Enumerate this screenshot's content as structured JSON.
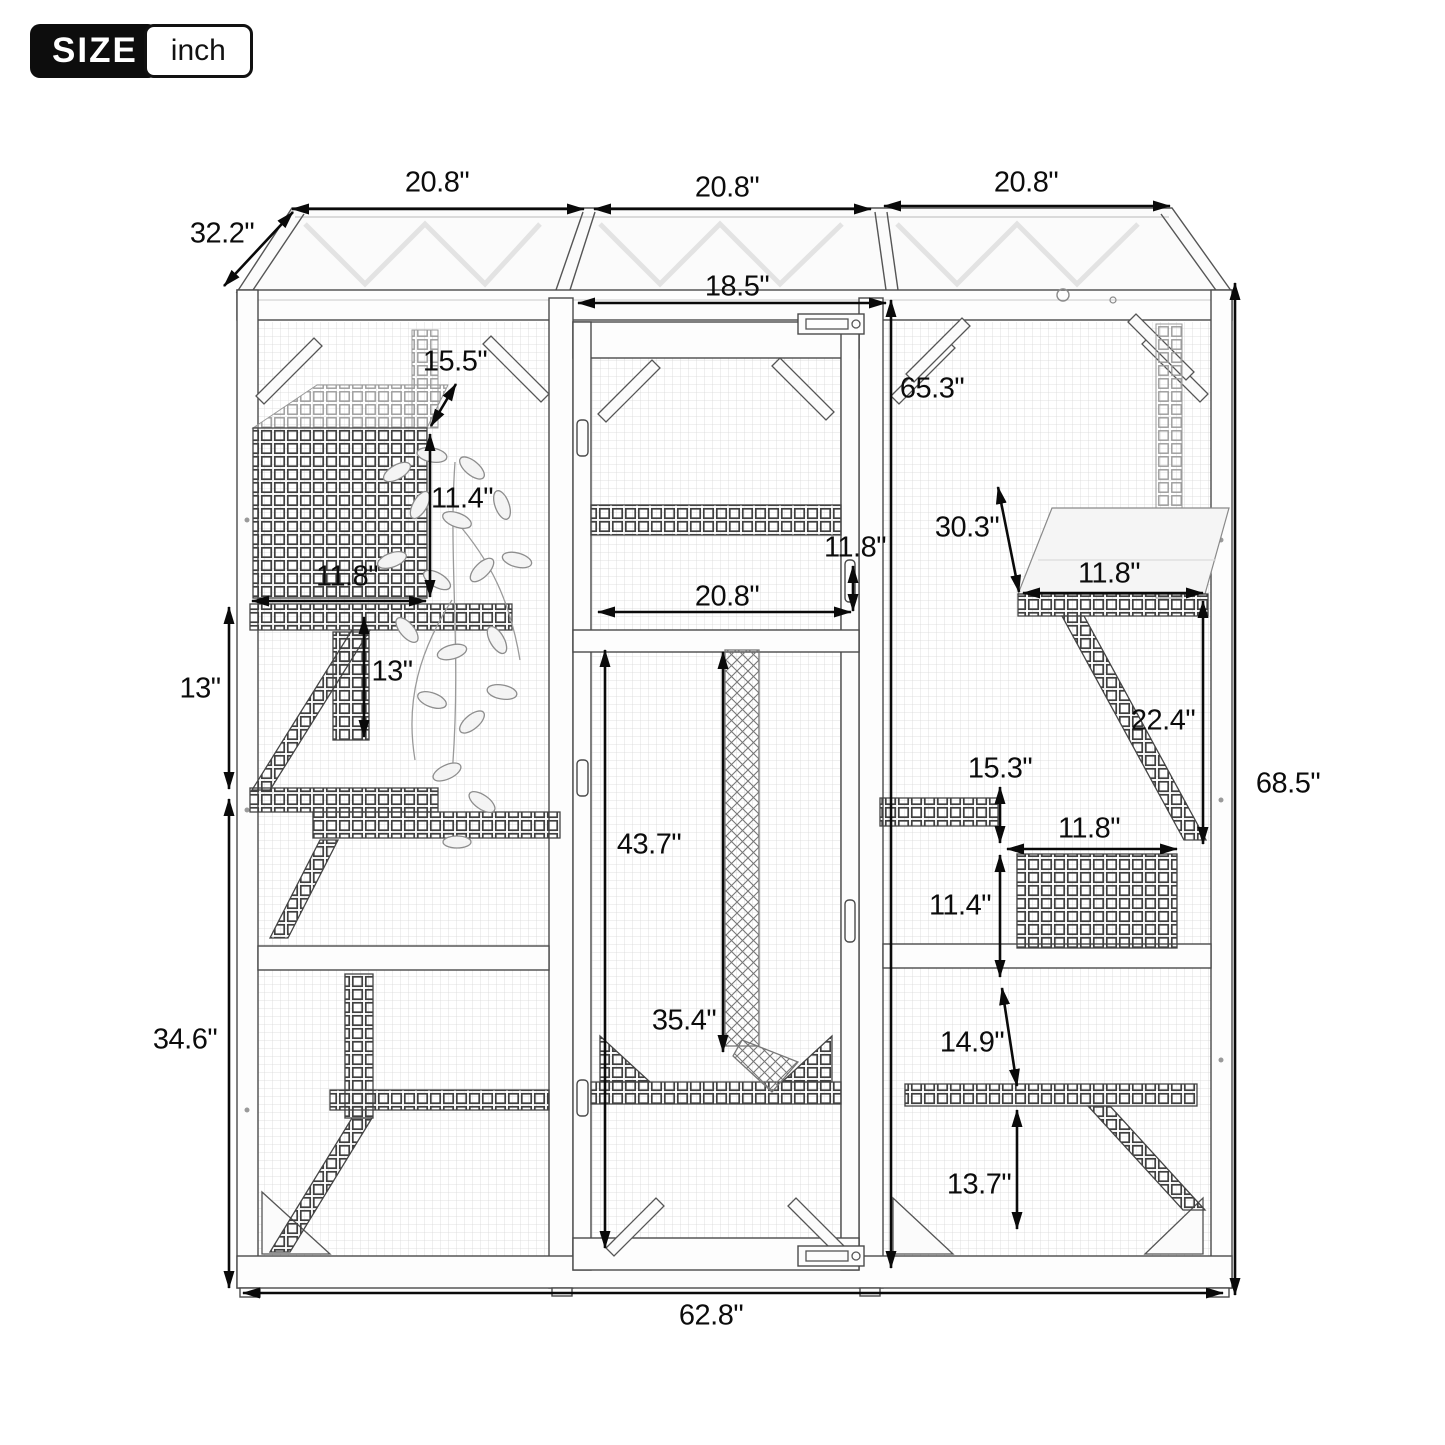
{
  "badge": {
    "size_label": "SIZE",
    "unit_label": "inch"
  },
  "diagram": {
    "dimensions": {
      "top_width_left": "20.8\"",
      "top_width_mid": "20.8\"",
      "top_width_right": "20.8\"",
      "roof_depth": "32.2\"",
      "door_width": "18.5\"",
      "house_opening": "15.5\"",
      "door_height": "65.3\"",
      "house_height": "11.4\"",
      "left_shelf_width": "11.8\"",
      "shelf_diag_right": "30.3\"",
      "door_shelf_gap": "11.8\"",
      "right_shelf_width": "11.8\"",
      "door_shelf_width": "20.8\"",
      "left_gap_outer": "13\"",
      "left_gap_inner": "13\"",
      "right_shelf_drop": "22.4\"",
      "right_box_gap": "15.3\"",
      "total_height": "68.5\"",
      "right_box_width": "11.8\"",
      "door_lower_height": "43.7\"",
      "right_box_height": "11.4\"",
      "rope_length": "35.4\"",
      "left_lower_height": "34.6\"",
      "right_ramp_drop": "14.9\"",
      "right_bottom_height": "13.7\"",
      "total_width": "62.8\""
    }
  }
}
